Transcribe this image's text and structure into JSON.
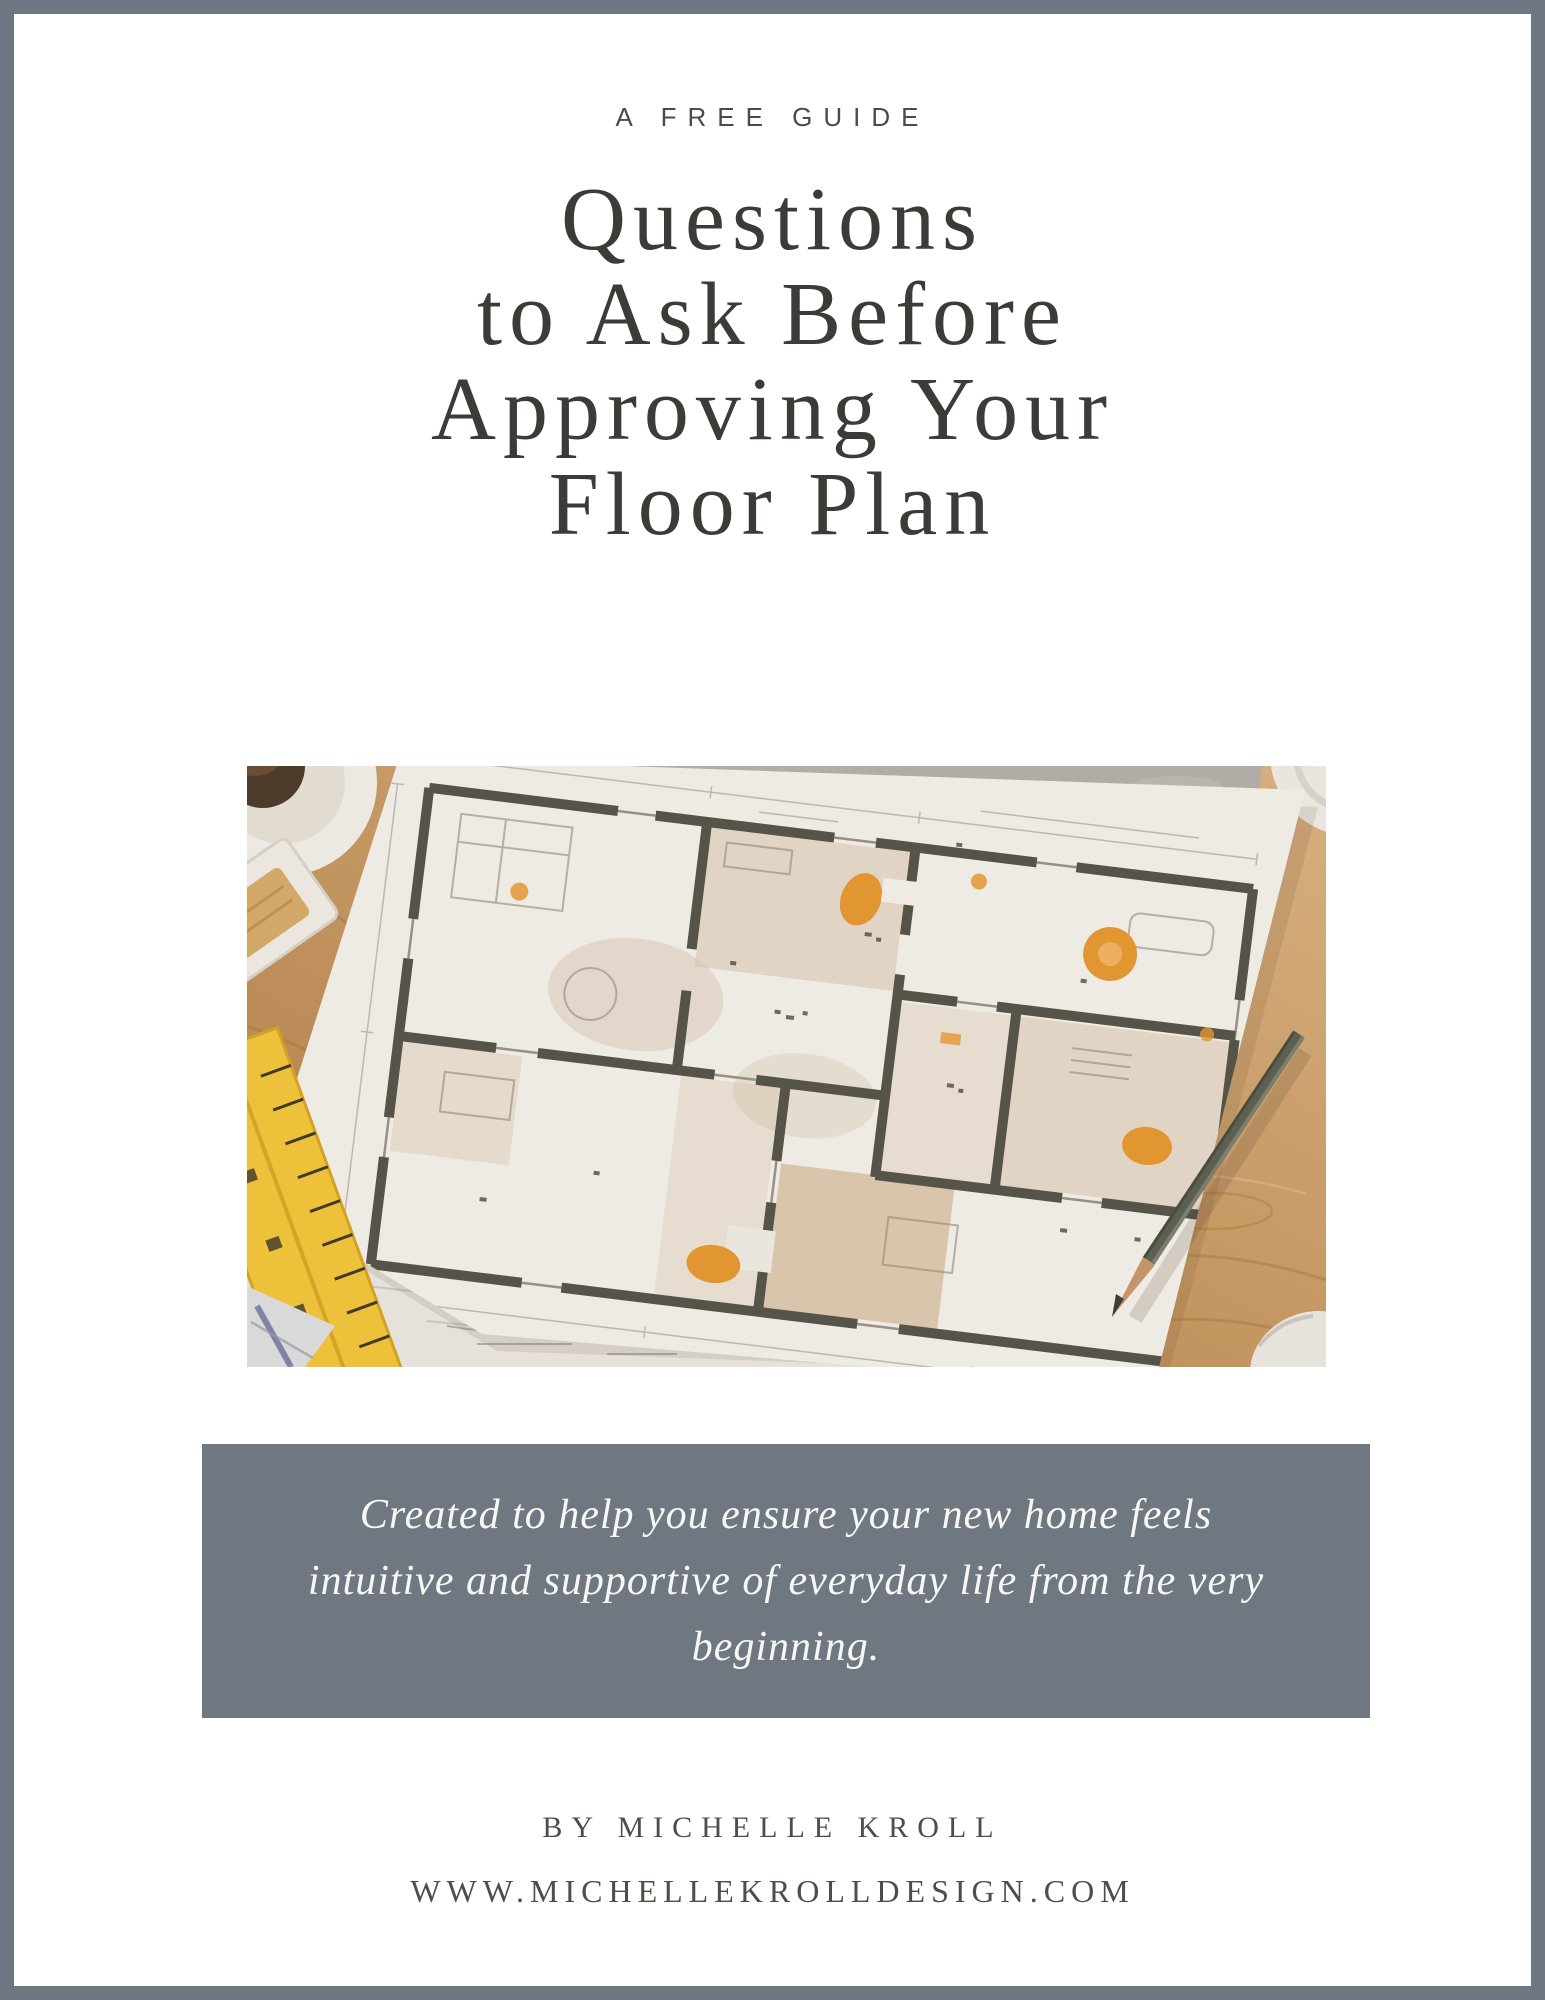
{
  "page": {
    "eyebrow": "A FREE GUIDE",
    "title_lines": [
      "Questions",
      "to Ask Before",
      "Approving Your",
      "Floor Plan"
    ],
    "quote_lines": [
      "Created to help you ensure your new home feels",
      "intuitive and supportive of everyday life from the very",
      "beginning."
    ],
    "byline": "BY MICHELLE KROLL",
    "website": "WWW.MICHELLEKROLLDESIGN.COM"
  },
  "photo": {
    "description": "Floor plan blueprint on a wooden desk with pencil, yellow ruler, coffee cup and computer mouse"
  },
  "colors": {
    "border_gray": "#6e7681",
    "quote_bg": "#6f7781",
    "quote_text": "#f8f7f3",
    "title_ink": "#3c3b38",
    "label_ink": "#4c4b49",
    "byline_ink": "#504d49",
    "wood": "#c79862",
    "wall": "#55544a",
    "room_tan": "#d9c2a4",
    "orange": "#e89a33",
    "paper": "#f5f3ef",
    "ruler_yellow": "#f4c83b"
  }
}
